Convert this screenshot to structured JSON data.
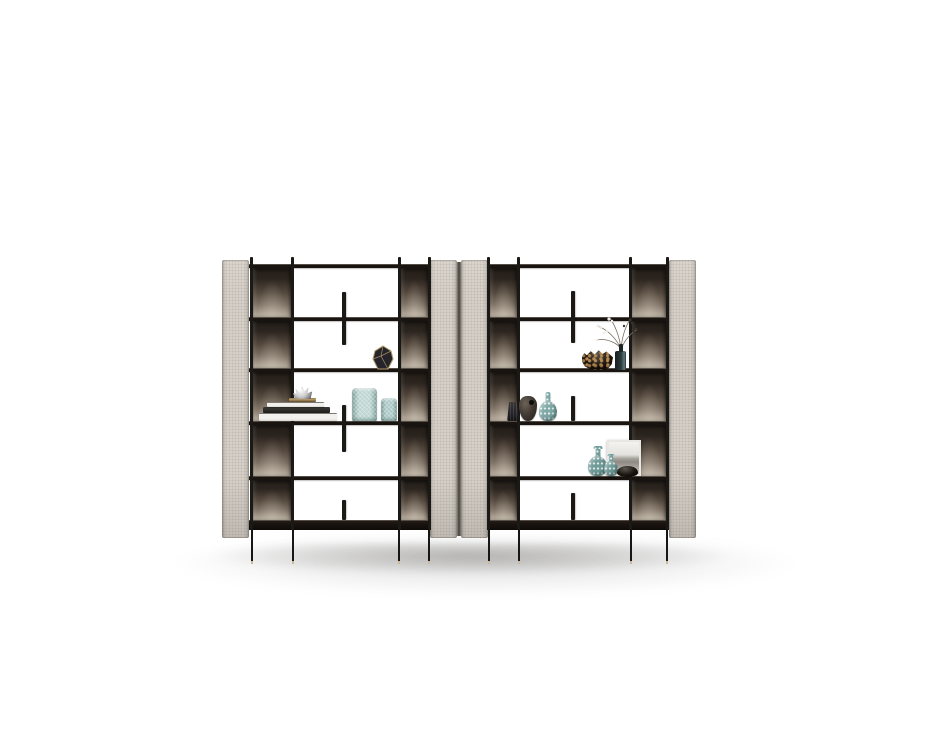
{
  "scene": {
    "description": "Studio product photo of two matching modern open bookcase units standing side by side on a white background with a soft floor shadow. Each unit has a slim black metal frame, five shelf rows, textured beige fabric side panels, smoked bronze corner back panels, small black vertical fin dividers and thin black legs with brass feet. Decorative vases, books, bowls and a framed print are styled on the shelves.",
    "units_count": 2,
    "rows_per_unit": 5,
    "legs_per_unit": 4
  },
  "palette": {
    "background": "#ffffff",
    "panel_beige": "#d5cfc7",
    "gap_dark": "#4a453f",
    "frame_black": "#1b1916",
    "shelf_dark": "#1a1410",
    "bronze_dark": "#211b16",
    "bronze_mid": "#55493e",
    "bronze_light": "#b3a899",
    "leg_black": "#161616",
    "foot_brass": "#cbb995",
    "shadow": "rgba(58,54,50,0.30)",
    "teal_glass": "#bcd5d1",
    "teal_glass_deep": "#a9c8c5",
    "teal_speckled": "#7ea8a6",
    "teal_vase": "#6f9b99",
    "gold_edge": "#b49a6a",
    "vase_black": "#26242b",
    "leopard_base": "#1a130d",
    "leopard_spot": "#b98c52",
    "silver": "#c9c9c9",
    "book_white": "#f2f1ed",
    "book_black": "#1d1c1a",
    "bottle_teal_dark": "#2b3a3c",
    "wood_dark": "#433c35",
    "frame_silver": "#e8e7e4",
    "photo_gray": "#a5a29b",
    "twig": "#7a6f60"
  },
  "objects": {
    "book_stack": "stack of coffee-table books with a silver ornament on top",
    "ribbed_vase_large": "large ribbed seafoam glass vase",
    "ribbed_vase_small": "small ribbed seafoam glass vase",
    "faceted_vase": "black faceted vase with gold edges",
    "leopard_bowl": "leopard-patterned round bowl",
    "flower_bottle": "dark glass bottle with dried flower sprigs",
    "crinkle_vase": "small black textured vase",
    "gourd_vessel": "dark gourd-shaped vessel with round opening",
    "speckled_bottle": "teal speckled bottle vase",
    "speckled_vase_large": "large teal patterned gourd vase",
    "speckled_vase_small": "small teal patterned gourd vase",
    "picture_frame": "framed gray landscape print leaning on shelf",
    "dark_bowl": "small black bowl"
  }
}
